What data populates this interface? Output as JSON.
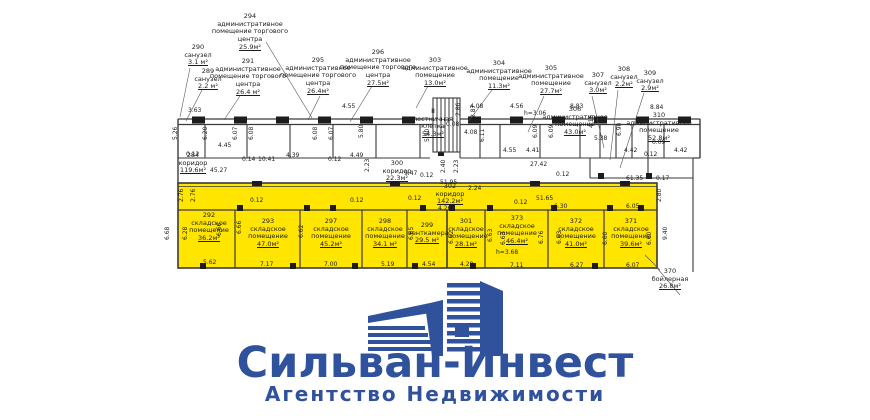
{
  "plan": {
    "colors": {
      "highlight": "#ffe500",
      "line": "#3a3a3a",
      "text": "#1c1c1c"
    },
    "top_labels": [
      {
        "number": "290",
        "name": "санузел",
        "area": "3.1 м²"
      },
      {
        "number": "289",
        "name": "санузел",
        "area": "2.2 м²"
      },
      {
        "number": "294",
        "name": "административное помещение торгового центра",
        "area": "25.9м²"
      },
      {
        "number": "291",
        "name": "административное помещение торгового центра",
        "area": "26.4 м²"
      },
      {
        "number": "295",
        "name": "административное помещение торгового центра",
        "area": "26.4м²"
      },
      {
        "number": "296",
        "name": "административное помещение торгового центра",
        "area": "27.5м²"
      },
      {
        "number": "303",
        "name": "административное помещение",
        "area": "13.0м²"
      },
      {
        "number": "304",
        "name": "административное помещение",
        "area": "11.3м²"
      },
      {
        "number": "305",
        "name": "административное помещение",
        "area": "27.7м²"
      },
      {
        "number": "307",
        "name": "санузел",
        "area": "3.0м²"
      },
      {
        "number": "308",
        "name": "санузел",
        "area": "2.2м²"
      },
      {
        "number": "309",
        "name": "санузел",
        "area": "2.9м²"
      },
      {
        "number": "306",
        "name": "административное помещение",
        "area": "43.0м²"
      },
      {
        "number": "310",
        "name": "административное помещение",
        "area": "52.8м²"
      },
      {
        "number": "II",
        "name": "лестничная клетка",
        "area": "54.3м²"
      },
      {
        "number": "284",
        "name": "коридор",
        "area": "119.6м²"
      },
      {
        "number": "300",
        "name": "коридор",
        "area": "22.3м²"
      },
      {
        "number": "370",
        "name": "бойлерная",
        "area": "26.8м²"
      }
    ],
    "yellow_labels": [
      {
        "number": "302",
        "name": "коридор",
        "area": "142.2м²"
      },
      {
        "number": "292",
        "name": "складское помещение",
        "area": "36.2м²"
      },
      {
        "number": "293",
        "name": "складское помещение",
        "area": "47.0м²"
      },
      {
        "number": "297",
        "name": "складское помещение",
        "area": "45.2м²"
      },
      {
        "number": "298",
        "name": "складское помещение",
        "area": "34.1 м²"
      },
      {
        "number": "299",
        "name": "венткамера",
        "area": "29.5 м²"
      },
      {
        "number": "301",
        "name": "складское помещение",
        "area": "28.1м²"
      },
      {
        "number": "373",
        "name": "складское помещение",
        "area": "46.4м²"
      },
      {
        "number": "372",
        "name": "складское помещение",
        "area": "41.0м²"
      },
      {
        "number": "371",
        "name": "складское помещение",
        "area": "39.6м²"
      }
    ],
    "dims": [
      "3.63",
      "4.55",
      "4.08",
      "4.56",
      "8.83",
      "8.84",
      "h=3.06",
      "4.45",
      "4.39",
      "4.49",
      "0.12",
      "0.14",
      "10.41",
      "0.12",
      "45.27",
      "9.47",
      "0.12",
      "4.08",
      "0.08",
      "4.41",
      "4.55",
      "27.42",
      "5.38",
      "4.42",
      "0.09",
      "0.12",
      "4.42",
      "61.35",
      "0.17",
      "0.12",
      "51.95",
      "0.12",
      "4.26",
      "51.65",
      "0.12",
      "6.30",
      "6.05",
      "0.12",
      "0.12",
      "2.24",
      "5.62",
      "7.17",
      "7.00",
      "5.19",
      "4.54",
      "4.28",
      "7.11",
      "6.27",
      "6.07",
      "h=3.68",
      "5.26",
      "6.20",
      "6.07",
      "6.08",
      "6.08",
      "6.07",
      "5.80",
      "5.90",
      "2.86",
      "2.87",
      "6.11",
      "6.09",
      "6.09",
      "4.16",
      "6.90",
      "2.23",
      "2.40",
      "2.23",
      "2.76",
      "2.76",
      "6.68",
      "6.28",
      "6.66",
      "6.66",
      "6.62",
      "6.65",
      "6.62",
      "6.63",
      "6.63",
      "6.76",
      "6.63",
      "6.60",
      "6.60",
      "9.40",
      "2.80"
    ]
  },
  "logo": {
    "title": "Сильван-Инвест",
    "subtitle": "Агентство Недвижимости",
    "color": "#30519c"
  }
}
